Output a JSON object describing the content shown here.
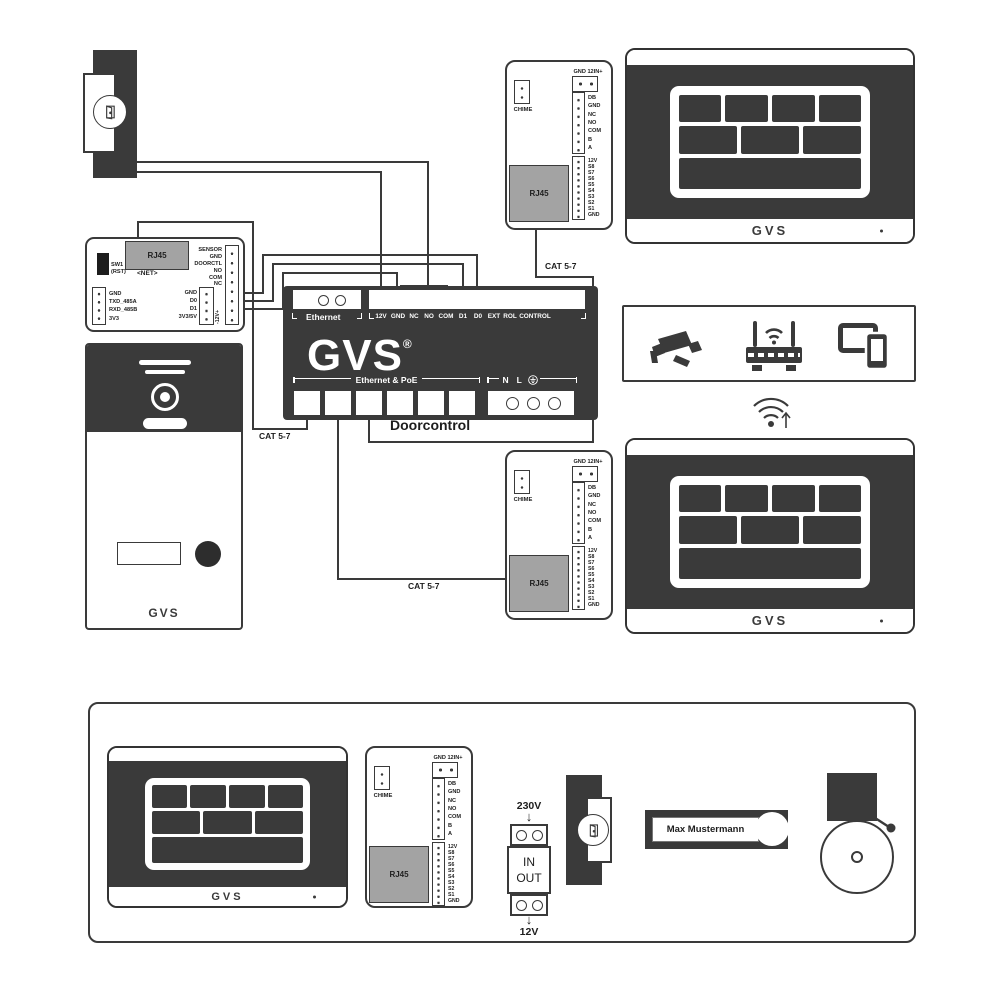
{
  "diagram": {
    "brand": "GVS",
    "reg": "®",
    "cat_label": "CAT 5-7",
    "doorcontrol": {
      "name": "Doorcontrol",
      "ethernet": "Ethernet",
      "poe": "Ethernet & PoE",
      "n": "N",
      "l": "L",
      "terminals": [
        "12V",
        "GND",
        "NC",
        "NO",
        "COM",
        "D1",
        "D0",
        "EXT",
        "ROL",
        "CONTROL"
      ]
    },
    "net_module": {
      "rj45": "RJ45",
      "net": "<NET>",
      "sw": "SW1 (RST)",
      "left_pins": [
        "GND",
        "TXD_485A",
        "RXD_485B",
        "3V3"
      ],
      "relay_pins": [
        "SENSOR",
        "GND",
        "DOORCTL",
        "NO",
        "COM",
        "NC"
      ],
      "io_pins": [
        "GND",
        "D0",
        "D1",
        "3V3/5V"
      ],
      "power": "-12V+"
    },
    "chime_module": {
      "chime": "CHIME",
      "top_label": "GND 12IN+",
      "bus_pins": [
        "DB",
        "GND",
        "NC",
        "NO",
        "COM",
        "B",
        "A"
      ],
      "s_pins": [
        "12V",
        "S8",
        "S7",
        "S6",
        "S5",
        "S4",
        "S3",
        "S2",
        "S1",
        "GND"
      ],
      "rj45": "RJ45"
    },
    "monitor_brand": "GVS",
    "station_brand": "GVS",
    "psu": {
      "input": "230V",
      "in": "IN",
      "out": "OUT",
      "output": "12V"
    },
    "nameplate": "Max Mustermann"
  }
}
